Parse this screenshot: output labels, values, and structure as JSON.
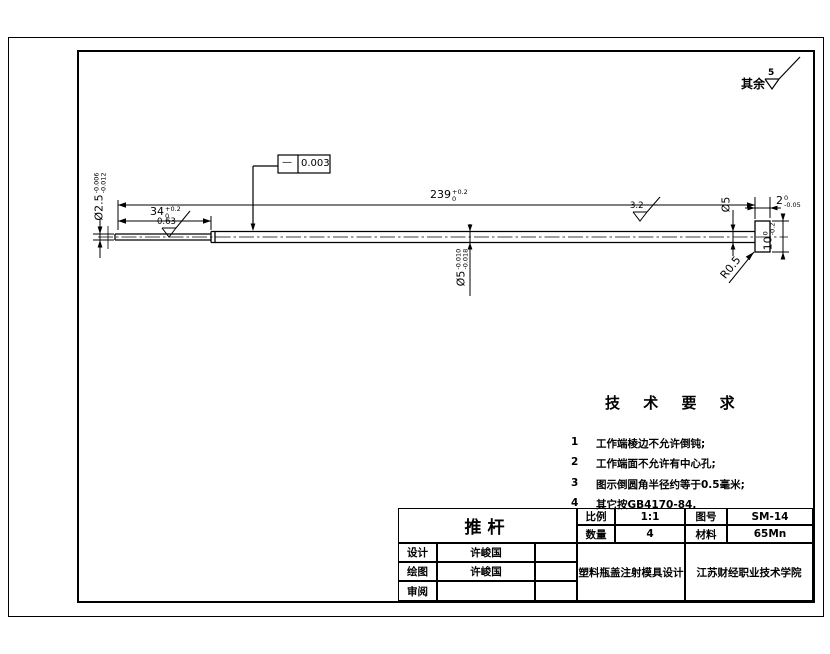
{
  "drawing": {
    "surface_note": {
      "prefix": "其余",
      "value": "5"
    },
    "tolerance_frame": {
      "symbol": "—",
      "value": "0.003"
    },
    "dims": {
      "d239": {
        "v": "239",
        "sup": "+0.2",
        "sub": "0"
      },
      "d34": {
        "v": "34",
        "sup": "+0.2",
        "sub": "0"
      },
      "d2_5": {
        "v": "Ø2.5",
        "sup": "-0.006",
        "sub": "-0.012"
      },
      "d5": {
        "v": "Ø5",
        "sup": "-0.010",
        "sub": "-0.018"
      },
      "d5_end": {
        "v": "Ø5"
      },
      "d2": {
        "v": "2",
        "sup": "0",
        "sub": "-0.05"
      },
      "d10": {
        "v": "10",
        "sup": "0",
        "sub": "-0.2"
      },
      "r": {
        "v": "R0.5"
      }
    },
    "roughness": {
      "small_shaft": "0.63",
      "main_shaft": "3.2"
    }
  },
  "tech_req": {
    "title": "技 术 要 求",
    "items": [
      {
        "num": "1",
        "text": "工作端棱边不允许倒钝;"
      },
      {
        "num": "2",
        "text": "工作端面不允许有中心孔;"
      },
      {
        "num": "3",
        "text": "图示倒圆角半径约等于0.5毫米;"
      },
      {
        "num": "4",
        "text": "其它按GB4170-84."
      }
    ]
  },
  "title_block": {
    "part_name": "推杆",
    "scale_label": "比例",
    "scale_value": "1:1",
    "qty_label": "数量",
    "qty_value": "4",
    "drawno_label": "图号",
    "drawno_value": "SM-14",
    "material_label": "材料",
    "material_value": "65Mn",
    "design_label": "设计",
    "design_value": "许峻国",
    "draw_label": "绘图",
    "draw_value": "许峻国",
    "review_label": "审阅",
    "review_value": "",
    "project": "塑料瓶盖注射模具设计",
    "org": "江苏财经职业技术学院"
  },
  "colors": {
    "line": "#000000",
    "background": "#ffffff"
  }
}
